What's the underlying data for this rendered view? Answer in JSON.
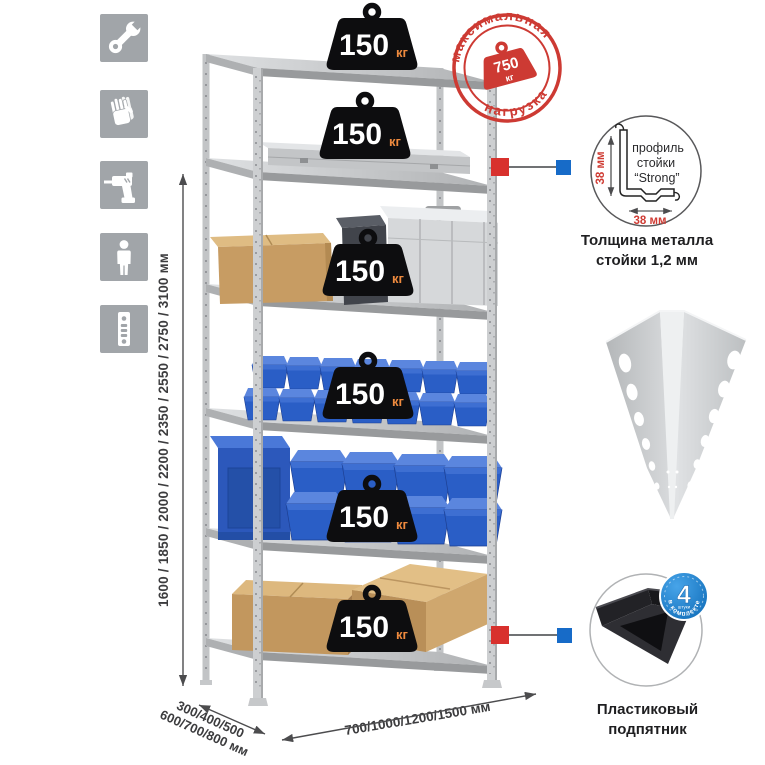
{
  "icons": {
    "bg_color": "#a1a5a9",
    "items": [
      {
        "name": "wrench"
      },
      {
        "name": "gloves"
      },
      {
        "name": "drill"
      },
      {
        "name": "person-height"
      },
      {
        "name": "rack-post"
      }
    ]
  },
  "dimensions": {
    "height_label": "1600 / 1850 / 2000 / 2200 / 2350 / 2550 / 2750 / 3100 мм",
    "depth_label_line1": "300/400/500",
    "depth_label_line2": "600/700/800 мм",
    "width_label": "700/1000/1200/1500 мм"
  },
  "shelves": [
    {
      "load": "150",
      "unit": "кг"
    },
    {
      "load": "150",
      "unit": "кг"
    },
    {
      "load": "150",
      "unit": "кг"
    },
    {
      "load": "150",
      "unit": "кг"
    },
    {
      "load": "150",
      "unit": "кг"
    },
    {
      "load": "150",
      "unit": "кг"
    }
  ],
  "stamp": {
    "arc_top": "максимальная",
    "arc_bottom": "нагрузка",
    "value": "750",
    "unit": "кг",
    "color": "#cd3a33"
  },
  "profile_detail": {
    "line1": "профиль",
    "line2": "стойки",
    "line3": "“Strong”",
    "dim_vertical": "38 мм",
    "dim_horizontal": "38 мм",
    "caption_line1": "Толщина металла",
    "caption_line2": "стойки 1,2 мм"
  },
  "foot_detail": {
    "badge_value": "4",
    "badge_small": "штуки",
    "badge_arc": "в комплекте",
    "caption_line1": "Пластиковый",
    "caption_line2": "подпятник"
  },
  "colors": {
    "accent_red": "#cd3a33",
    "marker_red": "#d8312d",
    "marker_blue": "#176bc8",
    "badge_blue": "#1e86d6",
    "bin_blue": "#2a5ec6",
    "metal_gray": "#c9cbcd"
  }
}
